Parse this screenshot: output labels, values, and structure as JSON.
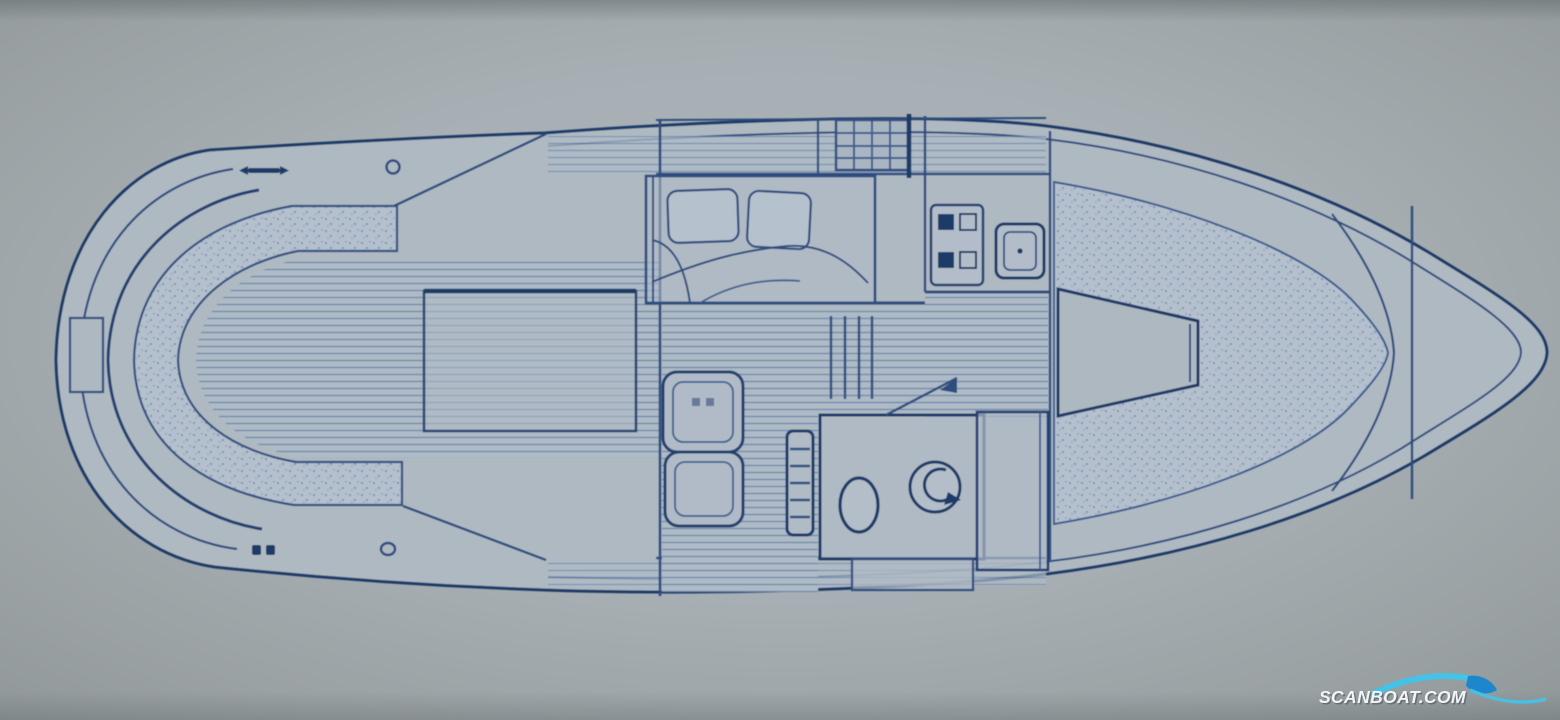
{
  "page": {
    "kind": "scanned boat floor plan (top view blueprint)",
    "orientation": "bow right, stern left"
  },
  "palette": {
    "background": "#9aa1a3",
    "paper": "#aeb7bf",
    "hull_fill": "#afb9c2",
    "ink": "#2e4d7e",
    "ink_dark": "#1f3a67",
    "ink_light": "#4f6fa0",
    "stipple_dot": "#6d87b2",
    "plank_line": "#4c6da1"
  },
  "watermark": {
    "text": "SCANBOAT.COM",
    "text_color": "#f2f5f7",
    "shadow_color": "rgba(55,65,75,0.45)",
    "wave_primary": "#45c2e8",
    "wave_secondary": "#1e86cc"
  },
  "floorplan": {
    "features": [
      {
        "id": "swim-platform",
        "area": "stern"
      },
      {
        "id": "cockpit-bench-seating",
        "area": "aft cockpit"
      },
      {
        "id": "cockpit-plank-floor",
        "area": "aft cockpit"
      },
      {
        "id": "engine-hatch",
        "area": "aft cockpit"
      },
      {
        "id": "deck-cleats-and-rings",
        "area": "side decks"
      },
      {
        "id": "double-berth",
        "area": "mid cabin"
      },
      {
        "id": "companionway-hatch-grate",
        "area": "cabin top"
      },
      {
        "id": "galley-stove",
        "area": "galley"
      },
      {
        "id": "galley-sink",
        "area": "galley"
      },
      {
        "id": "companionway-steps",
        "area": "mid cabin"
      },
      {
        "id": "salon-seats",
        "area": "salon"
      },
      {
        "id": "cabin-ladder",
        "area": "salon"
      },
      {
        "id": "toilet",
        "area": "head compartment"
      },
      {
        "id": "washbasin",
        "area": "head compartment"
      },
      {
        "id": "wardrobe",
        "area": "forward of head"
      },
      {
        "id": "v-berth-cushions",
        "area": "bow cabin"
      },
      {
        "id": "v-berth-insert",
        "area": "bow cabin"
      },
      {
        "id": "bow-deck-bulkheads",
        "area": "foredeck"
      }
    ]
  }
}
